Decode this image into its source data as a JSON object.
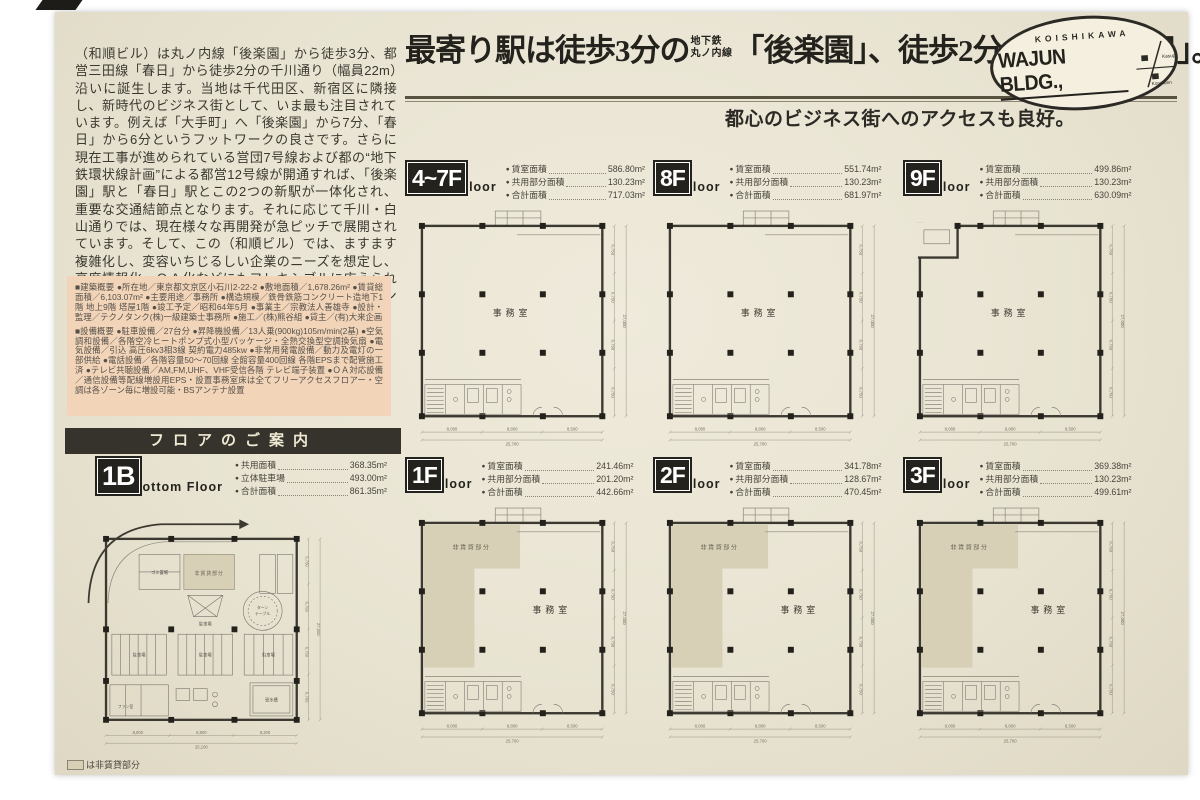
{
  "intro": {
    "text": "（和順ビル）は丸ノ内線「後楽園」から徒歩3分、都営三田線「春日」から徒歩2分の千川通り（幅員22m）沿いに誕生します。当地は千代田区、新宿区に隣接し、新時代のビジネス街として、いま最も注目されています。例えば「大手町」へ「後楽園」から7分、「春日」から6分というフットワークの良さです。さらに現在工事が進められている営団7号線および都の“地下鉄環状線計画”による都営12号線が開通すれば、「後楽園」駅と「春日」駅とこの2つの新駅が一体化され、重要な交通結節点となります。それに応じて千川・白山通りでは、現在様々な再開発が急ピッチで展開されています。そして、この（和順ビル）では、ますます複雑化し、変容いちじるしい企業のニーズを想定し、高度情報化、ＯＡ化などにもフレキシブルに応えられる「シャフト構造」「二重床構造」等を採用したインテリジェント対応ビルとなっています。"
  },
  "overview": {
    "building": "■建築概要 ●所在地／東京都文京区小石川2-22-2 ●敷地面積／1,678.26m² ●賃貸総面積／6,103.07m² ●主要用途／事務所 ●構造規模／鉄骨鉄筋コンクリート造地下1階 地上9階 塔屋1階 ●竣工予定／昭和64年5月 ●事業主／宗教法人善雄寺 ●設計・監理／テクノタンク(株)一級建築士事務所 ●施工／(株)熊谷組 ●貸主／(有)大来企画",
    "facilities": "■設備概要 ●駐車設備／27台分 ●昇降機設備／13人乗(900kg)105m/min(2基) ●空気調和設備／各階空冷ヒートポンプ式小型パッケージ・全熱交換型空調換気扇 ●電気設備／引込 高圧6kv3相3線 契約電力485kw ●非常用発電設備／動力及電灯の一部供給 ●電話設備／各階容量50～70回線 全館容量400回線 各階EPSまで配管施工済 ●テレビ共聴設備／AM,FM,UHF、VHF受信各階 テレビ端子装置 ●ＯＡ対応設備／通信設備等配線増設用EPS・設置事務室床は全てフリーアクセスフロアー・空調は各ゾーン毎に増設可能・BSアンテナ設置"
  },
  "floor_guide_header": "フロアのご案内",
  "headline": {
    "part1": "最寄り駅は徒歩3分の",
    "ruby1_line1": "地下鉄",
    "ruby1_line2": "丸ノ内線",
    "part2": "「後楽園」、徒歩2分の",
    "ruby2_line1": "地 下 鉄",
    "ruby2_line2": "都営三田線",
    "part3": "「春日」。",
    "subhead": "都心のビジネス街へのアクセスも良好。"
  },
  "logo": {
    "top": "KOISHIKAWA",
    "name": "WAJUN BLDG.,",
    "map_labels": [
      "Kasuga",
      "Korakuen"
    ]
  },
  "plan_labels": {
    "office": "事務室",
    "non_rental": "非賃貸部分",
    "parking": "駐車場",
    "turntable_1": "ターン",
    "turntable_2": "テーブル",
    "water_tank": "受水槽",
    "fan_room": "ファン室",
    "garbage": "ゴミ置場"
  },
  "dims": {
    "right": [
      "6,750",
      "6,750",
      "6,750",
      "6,750"
    ],
    "right_total": "27,000",
    "bottom": [
      "8,000",
      "8,800",
      "8,500"
    ],
    "bottom_total": "25,700",
    "b_right": [
      "5,750",
      "6,750",
      "6,750",
      "6,750"
    ],
    "b_right_total": "27,000",
    "b_bottom": [
      "8,000",
      "8,800",
      "8,200"
    ],
    "b_bottom_total": "25,100"
  },
  "floors": [
    {
      "id": "4-7f",
      "badge": "4~7F",
      "suffix": "loor",
      "plan": {
        "type": "office"
      },
      "stats": [
        {
          "label": "賃室面積",
          "value": "586.80m²"
        },
        {
          "label": "共用部分面積",
          "value": "130.23m²"
        },
        {
          "label": "合計面積",
          "value": "717.03m²"
        }
      ]
    },
    {
      "id": "8f",
      "badge": "8F",
      "suffix": "loor",
      "plan": {
        "type": "office"
      },
      "stats": [
        {
          "label": "賃室面積",
          "value": "551.74m²"
        },
        {
          "label": "共用部分面積",
          "value": "130.23m²"
        },
        {
          "label": "合計面積",
          "value": "681.97m²"
        }
      ]
    },
    {
      "id": "9f",
      "badge": "9F",
      "suffix": "loor",
      "plan": {
        "type": "office",
        "notch": true
      },
      "stats": [
        {
          "label": "賃室面積",
          "value": "499.86m²"
        },
        {
          "label": "共用部分面積",
          "value": "130.23m²"
        },
        {
          "label": "合計面積",
          "value": "630.09m²"
        }
      ]
    },
    {
      "id": "1f",
      "badge": "1F",
      "suffix": "loor",
      "plan": {
        "type": "office",
        "shaded": true
      },
      "stats": [
        {
          "label": "賃室面積",
          "value": "241.46m²"
        },
        {
          "label": "共用部分面積",
          "value": "201.20m²"
        },
        {
          "label": "合計面積",
          "value": "442.66m²"
        }
      ]
    },
    {
      "id": "2f",
      "badge": "2F",
      "suffix": "loor",
      "plan": {
        "type": "office",
        "shaded": true
      },
      "stats": [
        {
          "label": "賃室面積",
          "value": "341.78m²"
        },
        {
          "label": "共用部分面積",
          "value": "128.67m²"
        },
        {
          "label": "合計面積",
          "value": "470.45m²"
        }
      ]
    },
    {
      "id": "3f",
      "badge": "3F",
      "suffix": "loor",
      "plan": {
        "type": "office",
        "shaded": true
      },
      "stats": [
        {
          "label": "賃室面積",
          "value": "369.38m²"
        },
        {
          "label": "共用部分面積",
          "value": "130.23m²"
        },
        {
          "label": "合計面積",
          "value": "499.61m²"
        }
      ]
    }
  ],
  "basement": {
    "id": "1b",
    "badge": "1B",
    "suffix": "ottom Floor",
    "stats": [
      {
        "label": "共用面積",
        "value": "368.35m²"
      },
      {
        "label": "立体駐車場",
        "value": "493.00m²"
      },
      {
        "label": "合計面積",
        "value": "861.35m²"
      }
    ]
  },
  "legend": {
    "text": "は非賃貸部分"
  }
}
